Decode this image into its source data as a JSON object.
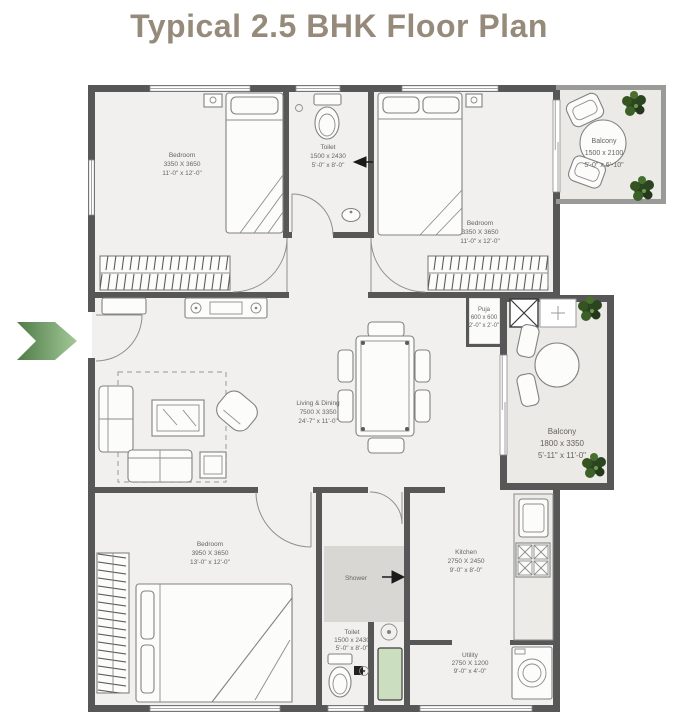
{
  "title": "Typical 2.5 BHK Floor Plan",
  "colors": {
    "title_text": "#968b7b",
    "wall": "#575757",
    "floor": "#f1f0ee",
    "balcony_floor": "#eceae6",
    "shower_floor": "#d8d7d3",
    "entry_arrow_dark_green": "#4e7c47",
    "entry_arrow_light_green": "#a4c898",
    "plant_green": "#2b4521",
    "utility_mat_green": "#cbdec0"
  },
  "entry": {
    "arrow_icon": "chevron-right"
  },
  "rooms": [
    {
      "id": "bedroom-1",
      "name": "Bedroom",
      "size_mm": "3350 X 3650",
      "size_ft": "11'-0\" x 12'-0\""
    },
    {
      "id": "toilet-1",
      "name": "Toilet",
      "size_mm": "1500 x 2430",
      "size_ft": "5'-0\" x 8'-0\""
    },
    {
      "id": "bedroom-2",
      "name": "Bedroom",
      "size_mm": "3350 X 3650",
      "size_ft": "11'-0\" x 12'-0\""
    },
    {
      "id": "balcony-1",
      "name": "Balcony",
      "size_mm": "1500 x 2100",
      "size_ft": "5'-0\" x 6'-10\""
    },
    {
      "id": "puja",
      "name": "Puja",
      "size_mm": "600 x 600",
      "size_ft": "2'-0\" x 2'-0\""
    },
    {
      "id": "living-dining",
      "name": "Living & Dining",
      "size_mm": "7500 X 3350",
      "size_ft": "24'-7\" x 11'-0\""
    },
    {
      "id": "balcony-2",
      "name": "Balcony",
      "size_mm": "1800 x 3350",
      "size_ft": "5'-11\" x 11'-0\""
    },
    {
      "id": "bedroom-3",
      "name": "Bedroom",
      "size_mm": "3950 X 3650",
      "size_ft": "13'-0\" x 12'-0\""
    },
    {
      "id": "shower",
      "name": "Shower",
      "size_mm": "",
      "size_ft": ""
    },
    {
      "id": "toilet-2",
      "name": "Toilet",
      "size_mm": "1500 x 2430",
      "size_ft": "5'-0\" x 8'-0\""
    },
    {
      "id": "kitchen",
      "name": "Kitchen",
      "size_mm": "2750 X 2450",
      "size_ft": "9'-0\" x 8'-0\""
    },
    {
      "id": "utility",
      "name": "Utility",
      "size_mm": "2750 X 1200",
      "size_ft": "9'-0\" x 4'-0\""
    }
  ]
}
